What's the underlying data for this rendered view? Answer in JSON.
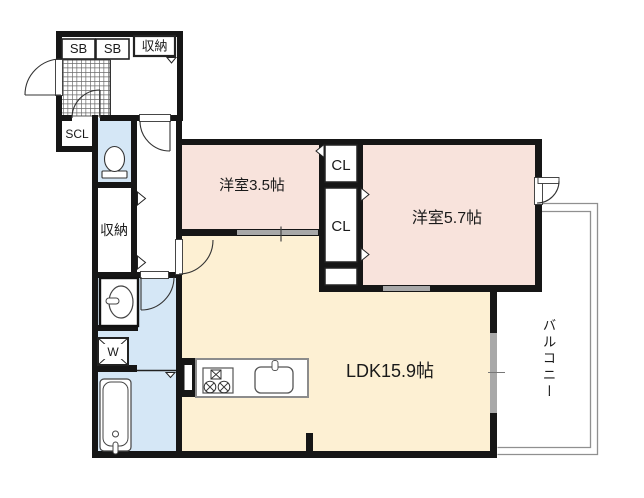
{
  "floorplan": {
    "labels": {
      "shoe_box_1": "SB",
      "shoe_box_2": "SB",
      "entry_storage": "収納",
      "shoe_closet": "SCL",
      "hall_storage": "収納",
      "washer": "W",
      "western_room_small": "洋室3.5帖",
      "closet_top": "CL",
      "closet_bottom": "CL",
      "western_room_large": "洋室5.7帖",
      "ldk": "LDK15.9帖",
      "balcony": "バルコニー"
    },
    "colors": {
      "wall": "#161616",
      "western_room_fill": "#f8e3dc",
      "ldk_fill": "#fdf0d3",
      "wet_area_fill": "#d5e7f6",
      "sliding_door_gray": "#a8a8a8",
      "balcony_outline": "#909090"
    }
  }
}
